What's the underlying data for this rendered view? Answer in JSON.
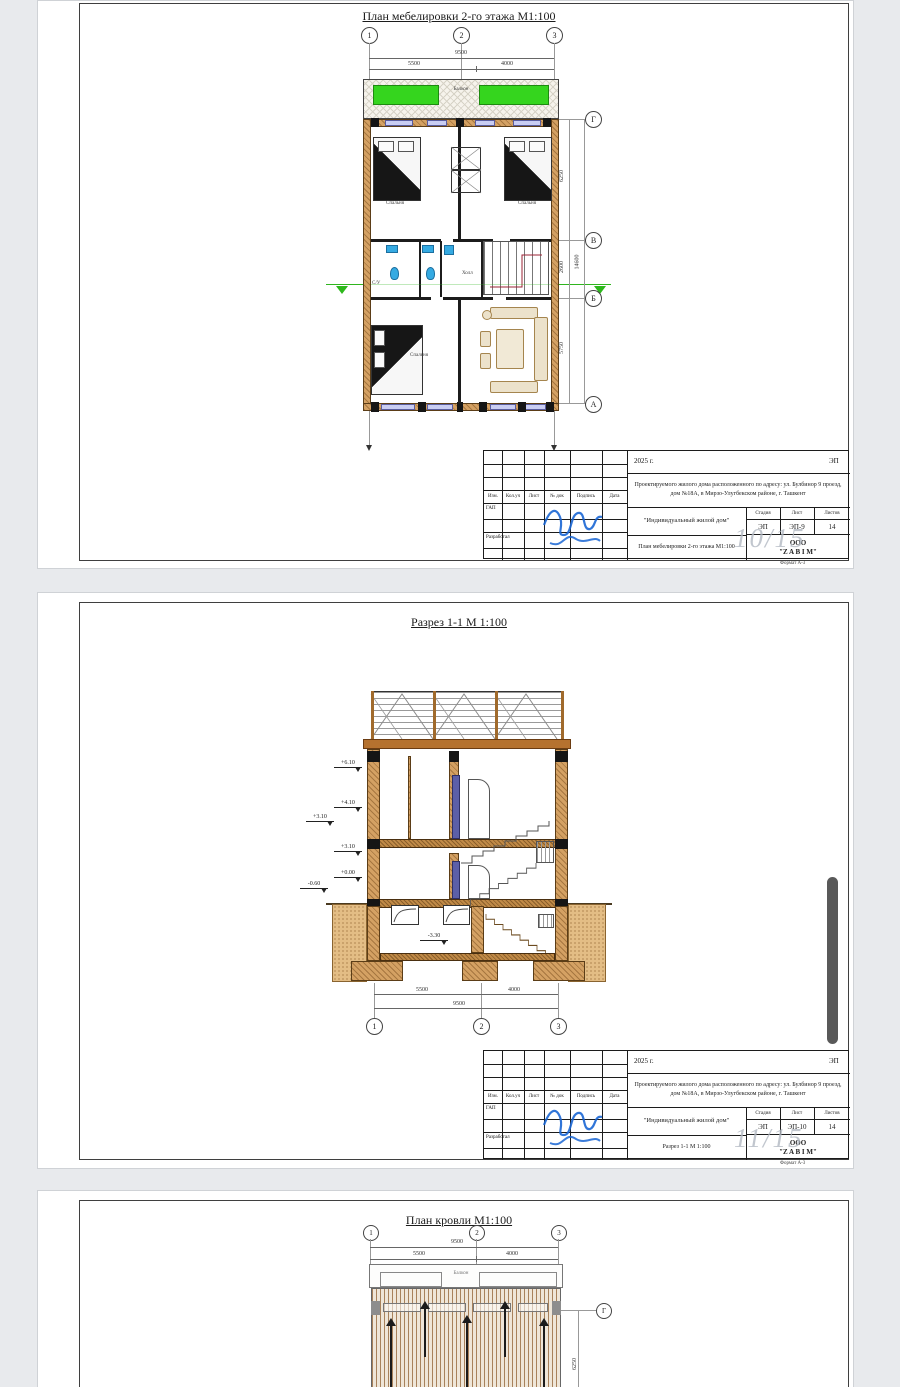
{
  "pages": [
    {
      "title": "План мебелировки 2-го этажа М1:100",
      "axes_top": [
        "1",
        "2",
        "3"
      ],
      "dims": {
        "total": "9500",
        "left": "5500",
        "right": "4000"
      },
      "axes_right": [
        "Г",
        "В",
        "Б",
        "А"
      ],
      "dims_right": {
        "gv": "6250",
        "vb": "2600",
        "ba": "5750",
        "total": "14600"
      },
      "rooms": {
        "balcony": "Балкон",
        "bedroom1": "Спальня",
        "bedroom2": "Спальня",
        "wc": "С/У",
        "hall": "Холл",
        "bedroom3": "Спальня"
      },
      "watermark": "10/15",
      "stamp": {
        "year": "2025 г.",
        "code": "ЭП",
        "address": "Проектируемого жилого дома расположенного по адресу: ул. Булбинор 9 проезд, дом №18А, в Мирзо-Улугбекском районе, г. Ташкент",
        "columns": [
          "Изм.",
          "Кол.уч",
          "Лист",
          "№ док",
          "Подпись",
          "Дата"
        ],
        "role_chief": "ГАП",
        "role_developer": "Разработал",
        "object_name": "\"Индивидуальный жилой дом\"",
        "stage_headers": [
          "Стадия",
          "Лист",
          "Листов"
        ],
        "stage": "ЭП",
        "sheet": "ЭП-9",
        "sheets_total": "14",
        "doc_title": "План мебелировки 2-го этажа М1:100",
        "company_line1": "ООО",
        "company_line2": "\"Z A B I M\"",
        "format_note": "Формат А-3"
      }
    },
    {
      "title": "Разрез 1-1 М 1:100",
      "elevations": [
        "+6.10",
        "+4.10",
        "+3.10",
        "+3.10",
        "+0.00",
        "-0.60"
      ],
      "basement_elevation": "-3.30",
      "dims": {
        "total": "9500",
        "left": "5500",
        "right": "4000"
      },
      "axes_bottom": [
        "1",
        "2",
        "3"
      ],
      "watermark": "11/15",
      "stamp": {
        "year": "2025 г.",
        "code": "ЭП",
        "address": "Проектируемого жилого дома расположенного по адресу: ул. Булбинор 9 проезд, дом №18А, в Мирзо-Улугбекском районе, г. Ташкент",
        "columns": [
          "Изм.",
          "Кол.уч",
          "Лист",
          "№ док",
          "Подпись",
          "Дата"
        ],
        "role_chief": "ГАП",
        "role_developer": "Разработал",
        "object_name": "\"Индивидуальный жилой дом\"",
        "stage_headers": [
          "Стадия",
          "Лист",
          "Листов"
        ],
        "stage": "ЭП",
        "sheet": "ЭП-10",
        "sheets_total": "14",
        "doc_title": "Разрез 1-1 М 1:100",
        "company_line1": "ООО",
        "company_line2": "\"Z A B I M\"",
        "format_note": "Формат А-3"
      }
    },
    {
      "title": "План кровли М1:100",
      "axes_top": [
        "1",
        "2",
        "3"
      ],
      "dims": {
        "total": "9500",
        "left": "5500",
        "right": "4000"
      },
      "roof_label": "Балкон",
      "axis_right": "Г",
      "dim_right": "6250"
    }
  ]
}
